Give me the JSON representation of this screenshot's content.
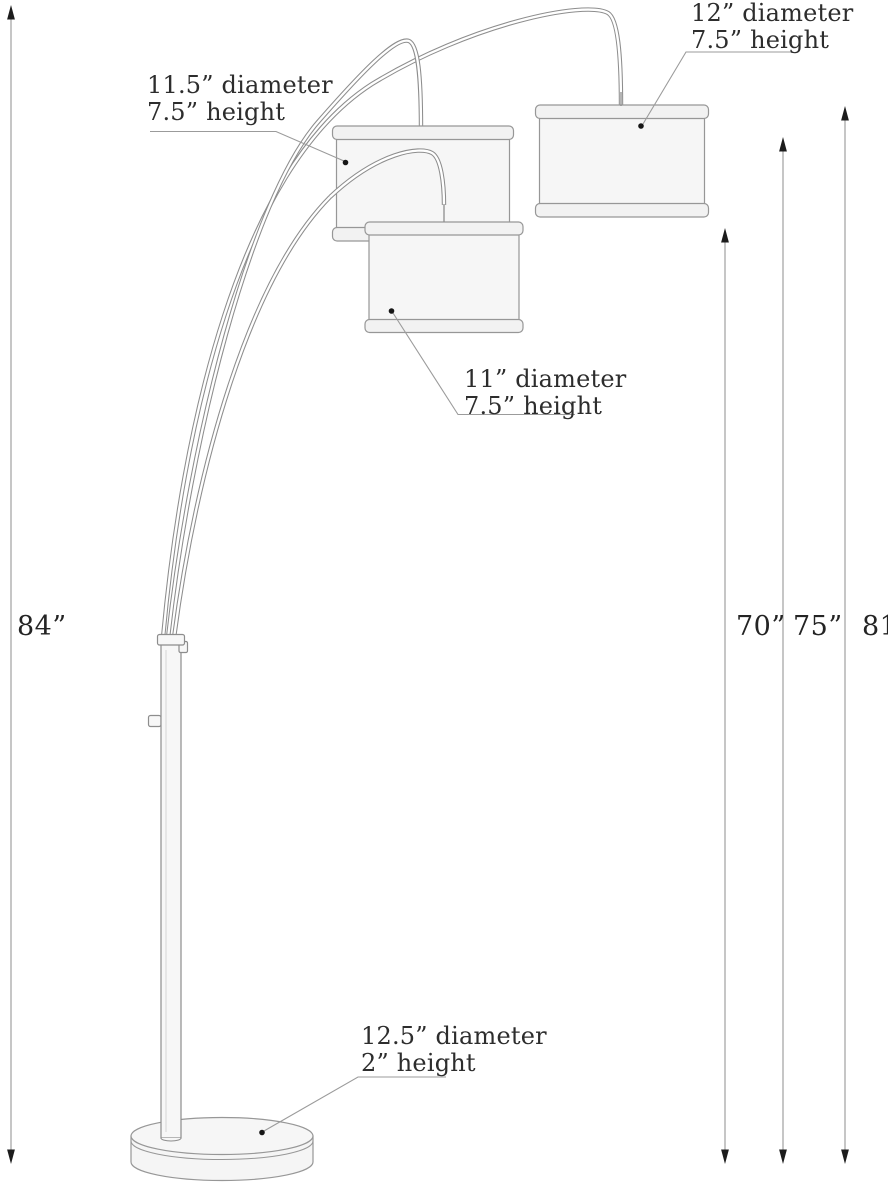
{
  "diagram_title": "arc-floor-lamp-dimension-diagram",
  "callouts": {
    "shade_mid": {
      "line1": "11.5” diameter",
      "line2": "7.5” height"
    },
    "shade_right": {
      "line1": "12” diameter",
      "line2": "7.5” height"
    },
    "shade_center": {
      "line1": "11” diameter",
      "line2": "7.5” height"
    },
    "base": {
      "line1": "12.5” diameter",
      "line2": "2” height"
    }
  },
  "dimensions": {
    "overall_height": "84”",
    "arm_center_height": "70”",
    "arm_mid_height": "75”",
    "arm_right_height": "81”"
  },
  "colors": {
    "outline": "#8d8d8d",
    "leader": "#9b9b9b",
    "dimension_line": "#a0a0a0",
    "arrowhead": "#1c1c1c",
    "text": "#2d2d2d",
    "shade_fill": "#f6f6f6",
    "band_fill": "#f2f2f2",
    "pole_fill": "#f7f7f7",
    "base_fill": "#f5f5f5"
  }
}
